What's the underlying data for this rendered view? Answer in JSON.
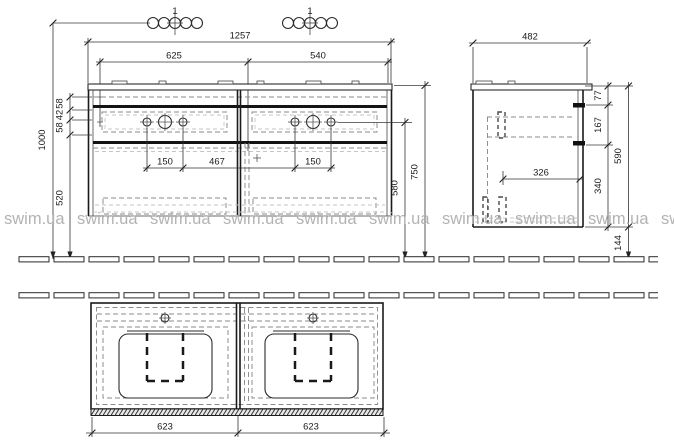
{
  "watermark": {
    "text": "swim.ua",
    "color": "#b3b3b3"
  },
  "faucet": {
    "left_label": "1",
    "right_label": "1"
  },
  "colors": {
    "line": "#2a2a2a",
    "hidden_line": "#8a8a8a",
    "watermark": "#b3b3b3"
  },
  "dims": {
    "front": {
      "overall": "1257",
      "left_span": "625",
      "right_span": "540",
      "total_height": "1000",
      "seg_top": "58",
      "seg_mid": "42",
      "seg_bot": "58",
      "lower_height": "520",
      "holes_left": "150",
      "holes_gap": "467",
      "holes_right": "150",
      "counter_height": "750",
      "holes_height": "580"
    },
    "side": {
      "depth": "482",
      "top_offset": "77",
      "handle_spacing": "167",
      "body_height": "590",
      "inner_depth": "326",
      "lower_offset": "340",
      "floor_clearance": "144"
    },
    "plan": {
      "left_width": "623",
      "right_width": "623"
    }
  }
}
